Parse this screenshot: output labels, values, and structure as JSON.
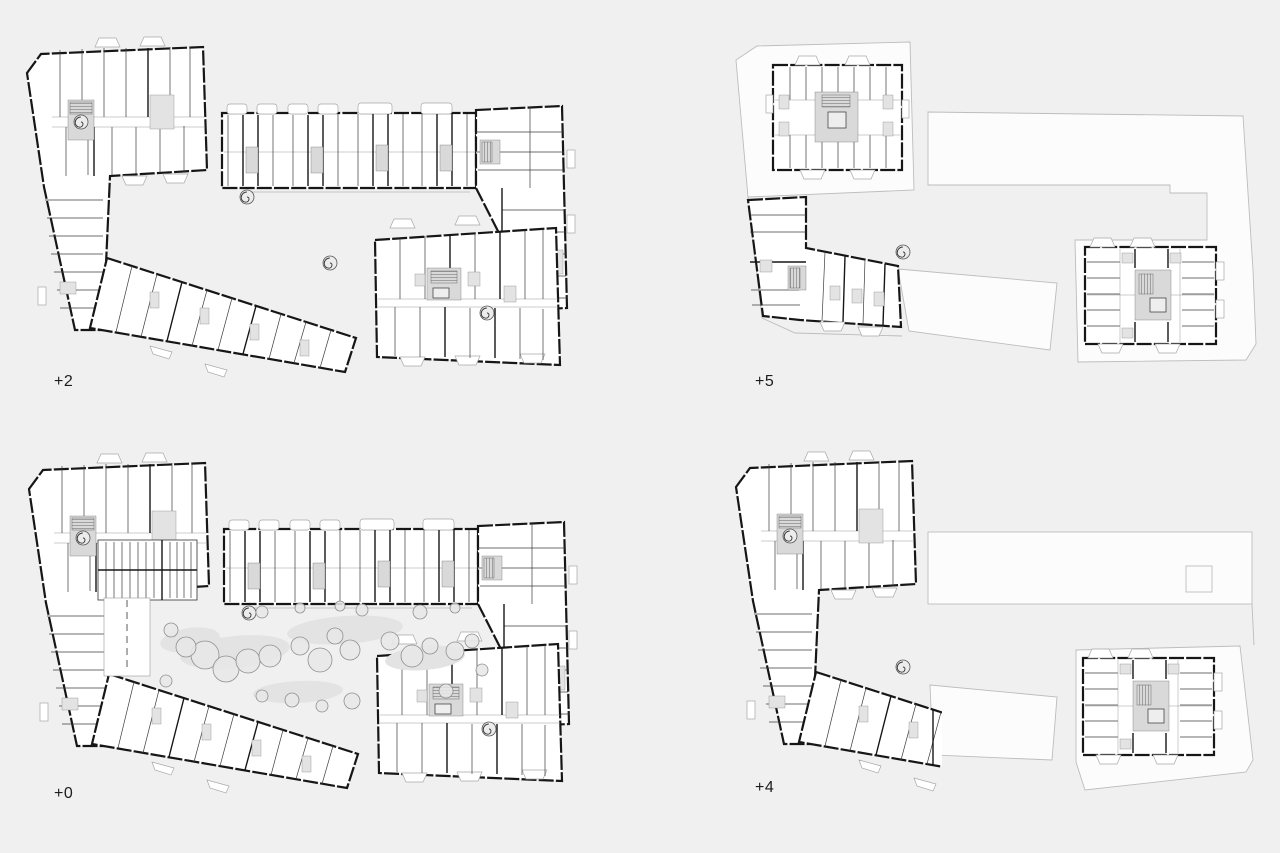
{
  "sheet": {
    "background_color": "#f0f0f1",
    "content": "architectural floor plan drawings, 2x2 arrangement"
  },
  "plans": [
    {
      "id": "plus-2",
      "label": "+2",
      "position": "top-left"
    },
    {
      "id": "plus-5",
      "label": "+5",
      "position": "top-right"
    },
    {
      "id": "plus-0",
      "label": "+0",
      "position": "bottom-left"
    },
    {
      "id": "plus-4",
      "label": "+4",
      "position": "bottom-right"
    }
  ],
  "colors": {
    "wall": "#161616",
    "roof_outline": "#bdbdbd",
    "core_fill": "#d9d9d9",
    "tree_fill": "#e7e7e7",
    "tree_stroke": "#8f8f8f",
    "label": "#1c1c1c"
  }
}
